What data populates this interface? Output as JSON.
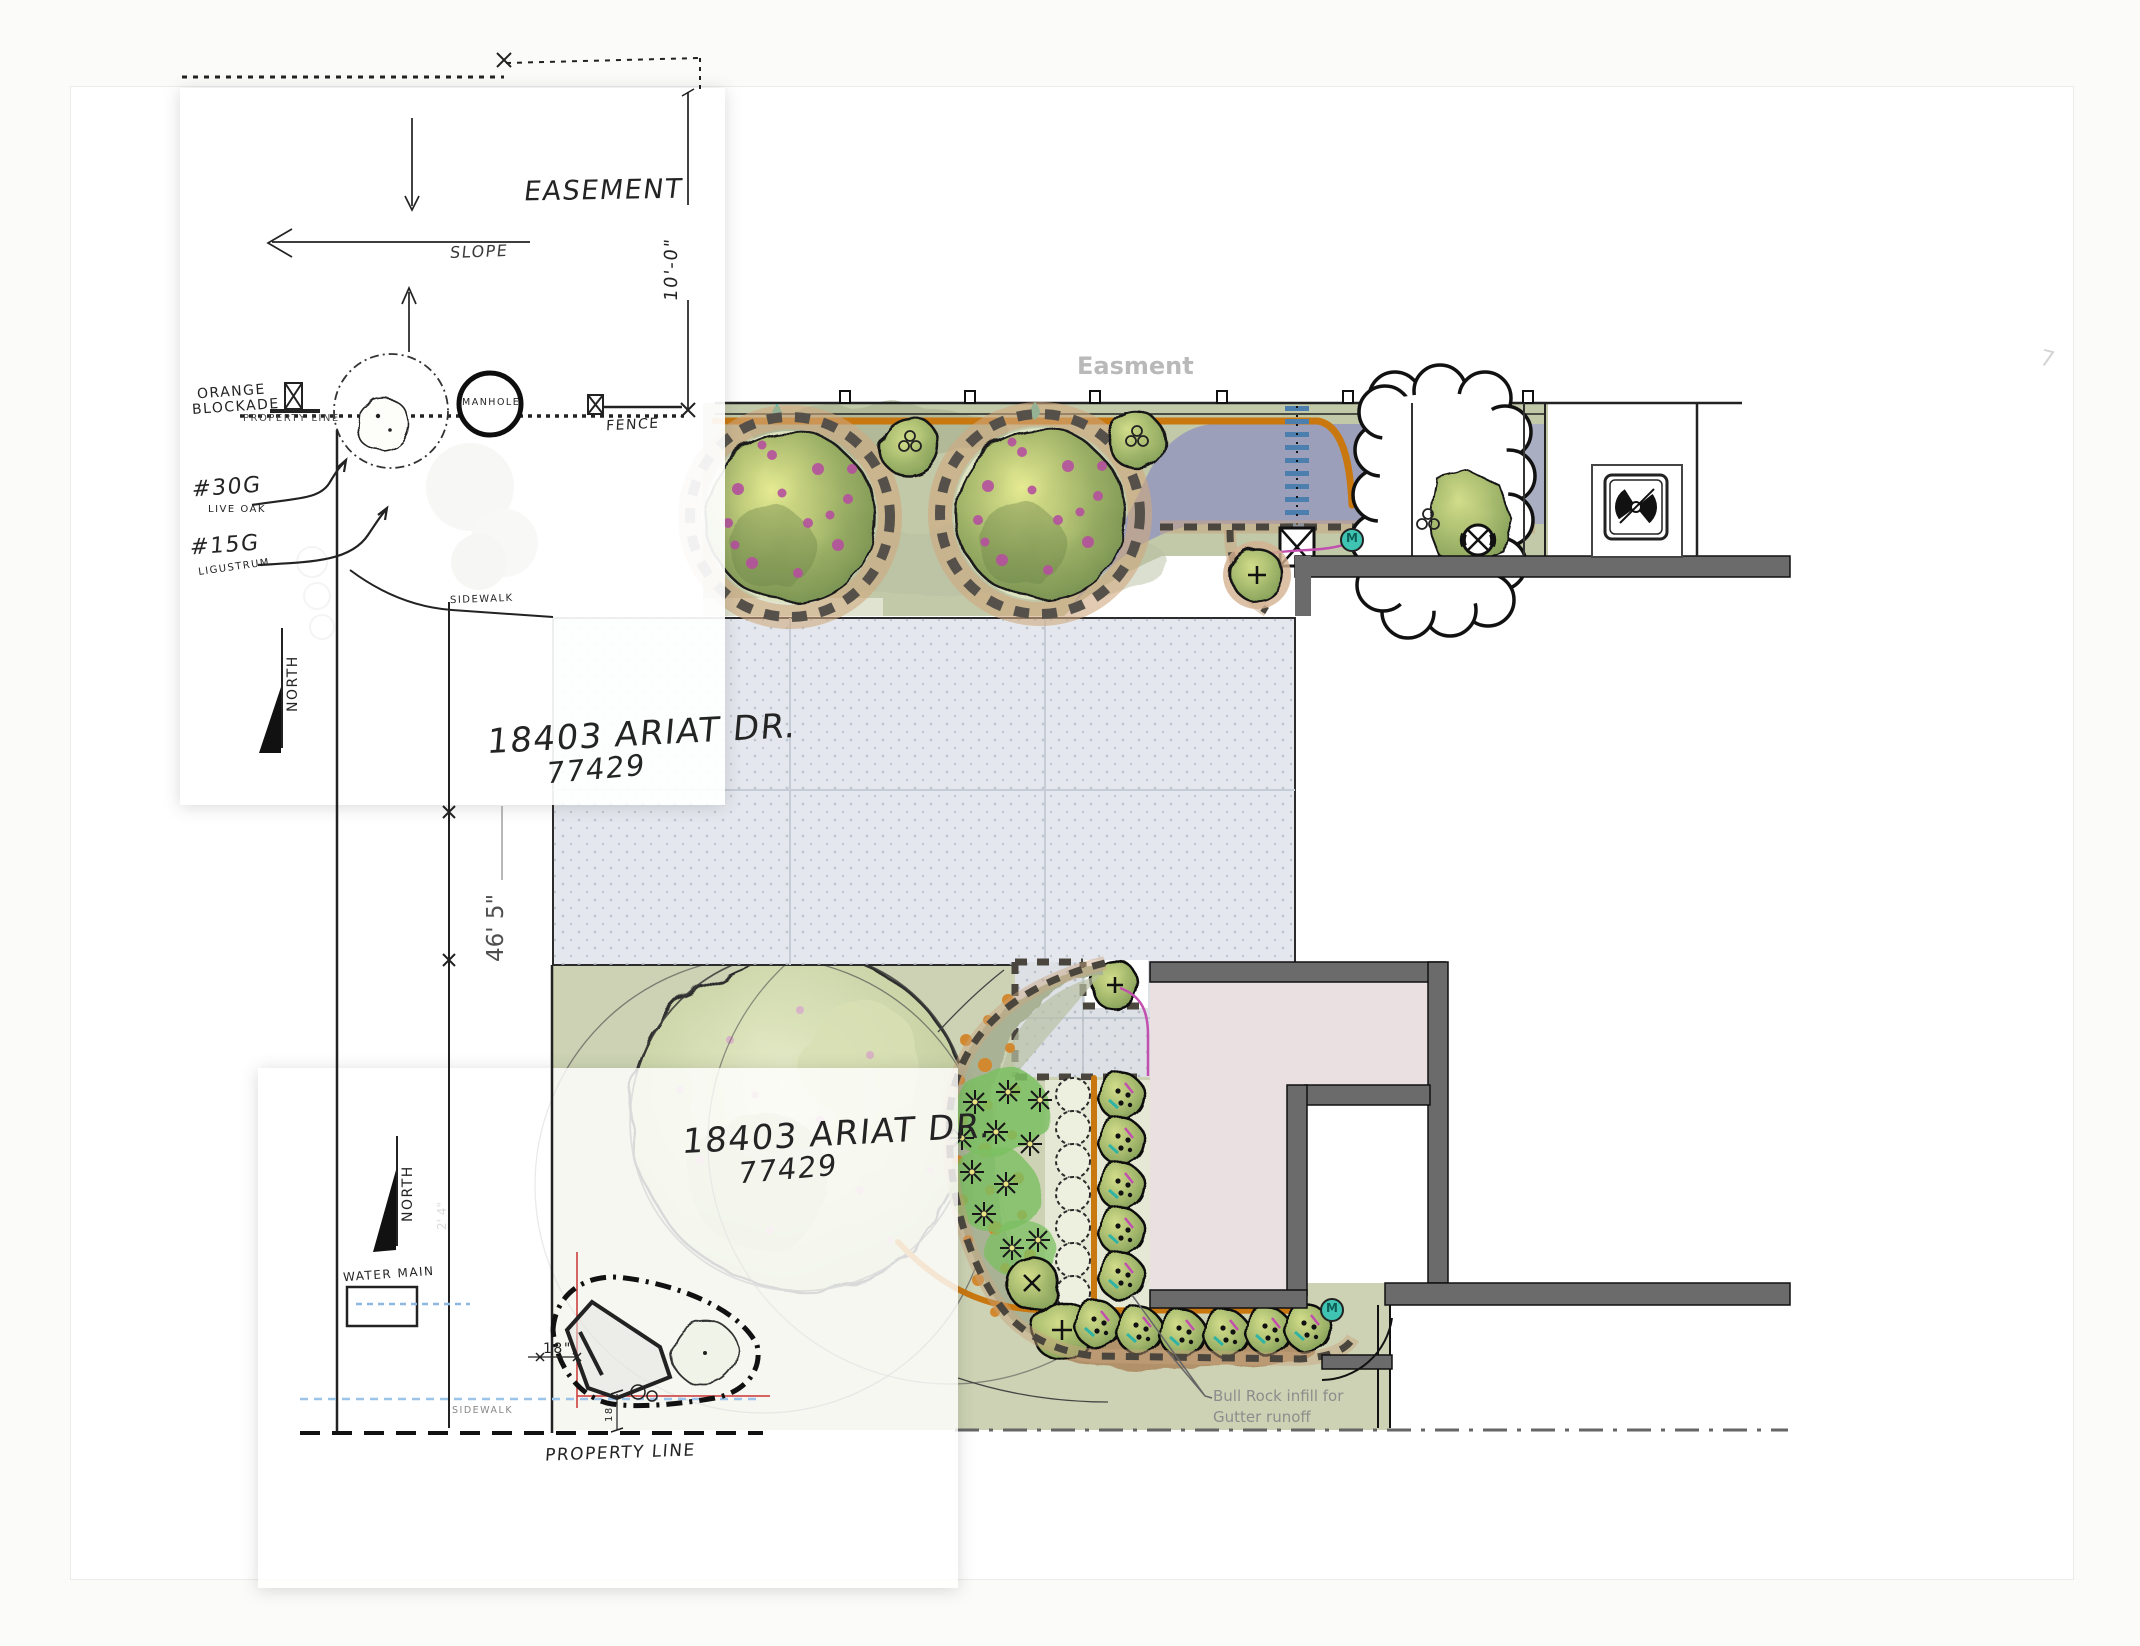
{
  "sheet1": {
    "easement": "EASEMENT",
    "slope": "SLOPE",
    "dim_10": "10'-0\"",
    "orange_blockade_1": "ORANGE",
    "orange_blockade_2": "BLOCKADE",
    "property_line_small": "PROPERTY LINE",
    "manhole": "MANHOLE",
    "fence": "FENCE",
    "tag_30g": "#30G",
    "tag_30g_name": "LIVE OAK",
    "tag_15g": "#15G",
    "tag_15g_name": "LIGUSTRUM",
    "north": "NORTH",
    "sidewalk": "SIDEWALK"
  },
  "canvas": {
    "address_line1": "18403 ARIAT DR.",
    "address_line2": "77429",
    "easment_label": "Easment",
    "driveway_dim": "46' 5\"",
    "meter_label": "M",
    "note_line1": "Bull Rock infill for",
    "note_line2": "Gutter runoff",
    "corner_mark": "7"
  },
  "sheet2": {
    "north": "NORTH",
    "water_main": "WATER MAIN",
    "dim_18": "18\"",
    "dim_18_vert": "18",
    "sidewalk": "SIDEWALK",
    "property_line": "PROPERTY LINE",
    "faint_dim": "2' 4\""
  },
  "colors": {
    "lawn": "#ccd2b3",
    "bed_green": "#c2c9a9",
    "purple_bed": "#9c9fba",
    "pipe_orange": "#c9770f",
    "teal": "#3fc4b4",
    "magenta": "#c24fb0",
    "house_pink": "#eae0e1",
    "wall_gray": "#6b6b6b",
    "drive_gray": "#e4e8ee"
  }
}
